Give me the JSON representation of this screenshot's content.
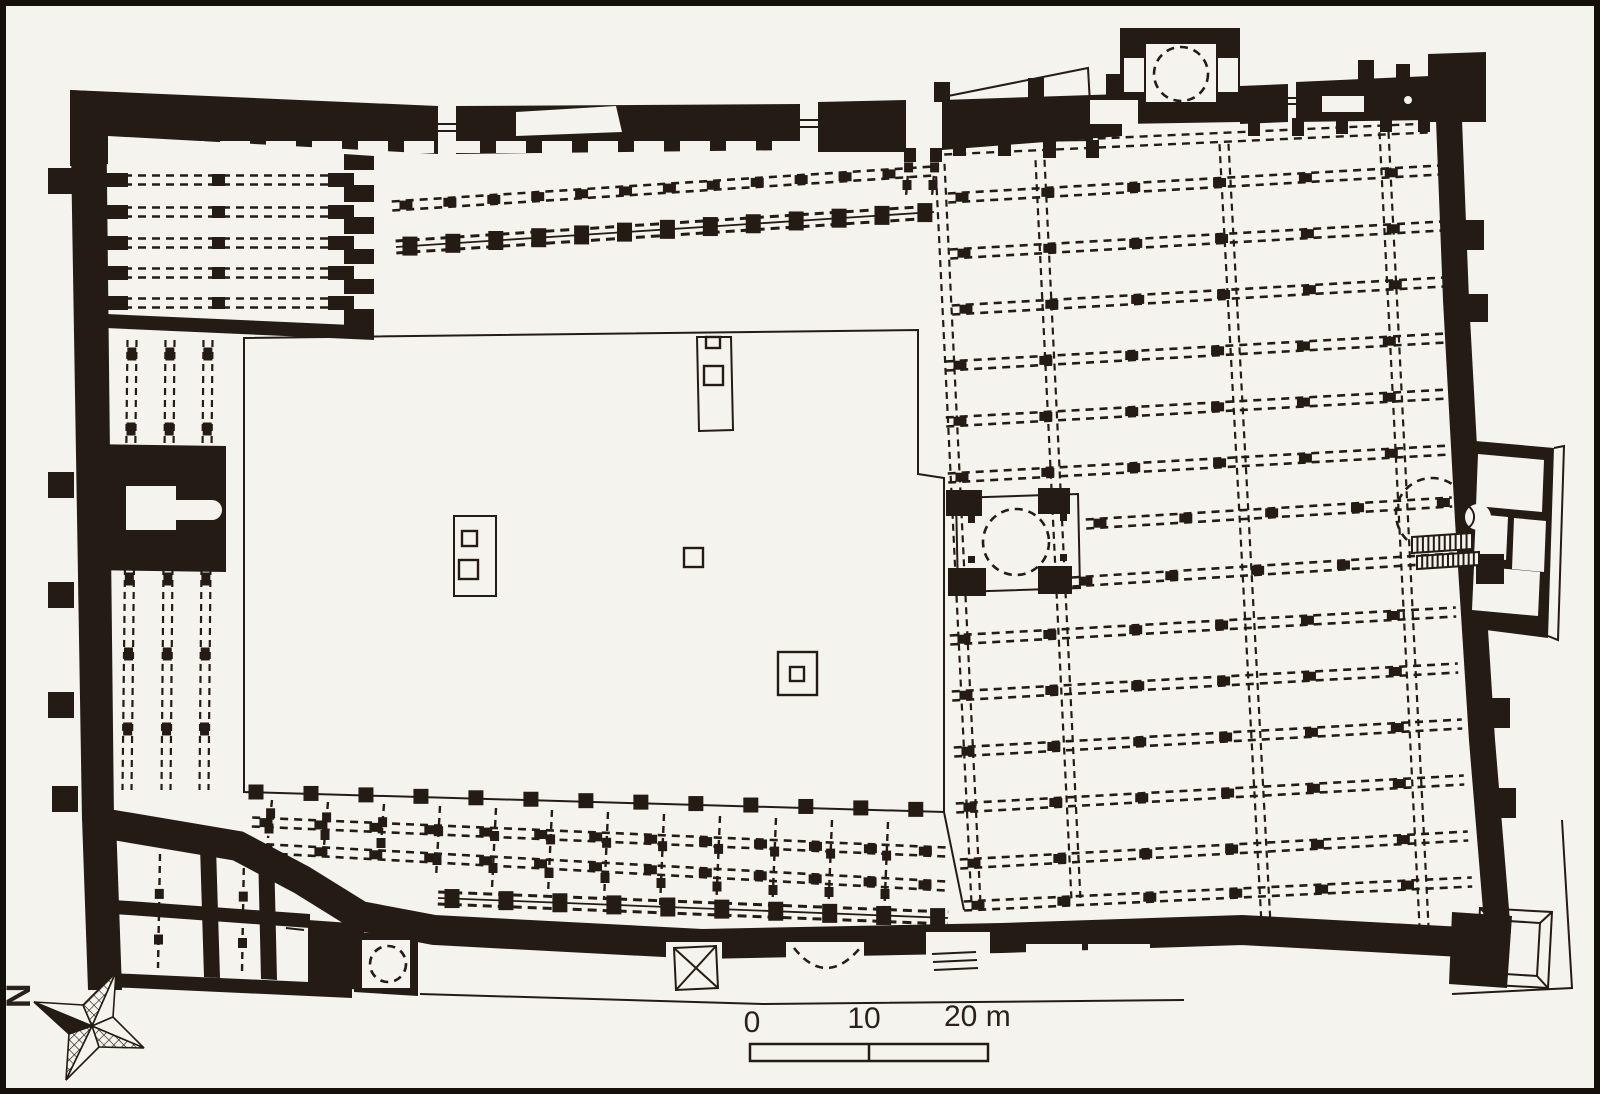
{
  "meta": {
    "kind": "architectural-floor-plan",
    "subject": "hypostyle mosque plan with central courtyard, riwaq arcades, qibla hall, dome bays, mihrab"
  },
  "colors": {
    "ink": "#241b15",
    "paper": "#f5f3ed",
    "frame": "#16100a",
    "text": "#2a211c"
  },
  "compass": {
    "label": "N",
    "polys": [
      {
        "pts": "34,1002 83,1005 92,1026",
        "f": "paper"
      },
      {
        "pts": "34,1002 92,1026 69,1034",
        "f": "ink"
      },
      {
        "pts": "116,972 83,1005 92,1026",
        "f": "hatch"
      },
      {
        "pts": "116,972 92,1026 113,1017",
        "f": "paper"
      },
      {
        "pts": "144,1048 113,1017 92,1026",
        "f": "paper"
      },
      {
        "pts": "144,1048 92,1026 99,1047",
        "f": "hatch"
      },
      {
        "pts": "66,1080 69,1034 92,1026",
        "f": "hatch"
      },
      {
        "pts": "66,1080 92,1026 99,1047",
        "f": "paper"
      }
    ]
  },
  "scalebar": {
    "x": 750,
    "y": 1044,
    "w": 238,
    "h": 17,
    "div": 869,
    "labels": [
      {
        "t": "0",
        "x": 752,
        "y": 1032,
        "a": "middle"
      },
      {
        "t": "10",
        "x": 864,
        "y": 1028,
        "a": "middle"
      },
      {
        "t": "20 m",
        "x": 944,
        "y": 1026,
        "a": "start"
      }
    ]
  },
  "plan": {
    "walls": [
      "M70,90 L438,106 L438,154 L108,136 L108,164 L70,166 Z",
      "M456,106 L800,104 L800,150 L456,154 Z",
      "M818,102 L906,100 L906,152 L818,152 Z",
      "M942,100 L1122,94 L1122,136 L942,150 Z",
      "M1120,28 L1240,28 L1240,122 L1120,124 Z",
      "M1240,86 L1288,84 L1288,122 L1240,124 Z",
      "M1296,82 L1430,76 L1430,120 L1296,122 Z",
      "M1428,54 L1486,52 L1486,122 L1428,122 Z",
      "M70,90 L106,92 L114,820 L82,820 Z",
      "M344,154 L374,156 L374,334 L344,332 Z",
      "M106,314 L374,326 L374,340 L106,328 Z",
      "M84,444 L226,446 L226,572 L84,570 Z",
      "M308,920 L364,924 L364,990 L308,986 Z",
      "M354,932 L418,936 L418,996 L354,992 Z",
      "M82,818 L116,820 L122,990 L88,990 Z",
      "M88,972 L352,984 L352,998 L88,986 Z",
      "M114,900 L310,914 L310,928 L114,914 Z",
      "M200,846 L216,847 L220,978 L204,977 Z",
      "M258,850 L274,851 L277,980 L261,979 Z",
      "M1464,440 L1554,448 L1548,638 L1470,628 Z",
      "M1452,912 L1512,916 L1507,988 L1449,984 Z"
    ],
    "wallStrokes": [
      {
        "d": "M1448,94 L1456,300 L1468,520 L1482,740 L1498,934",
        "w": 26
      },
      {
        "d": "M96,822 L238,846 L302,880 L360,916 L434,930 L702,944 L1002,938 L1242,930 L1462,942",
        "w": 30
      }
    ],
    "blocks": [
      [
        1458,
        220,
        26,
        30
      ],
      [
        1462,
        294,
        26,
        28
      ],
      [
        1476,
        554,
        28,
        30
      ],
      [
        1482,
        698,
        28,
        30
      ],
      [
        1488,
        788,
        28,
        30
      ],
      [
        934,
        82,
        16,
        20
      ],
      [
        1028,
        78,
        16,
        20
      ],
      [
        1106,
        74,
        16,
        22
      ],
      [
        1358,
        60,
        16,
        20
      ],
      [
        1396,
        64,
        14,
        18
      ],
      [
        953,
        138,
        13,
        18
      ],
      [
        998,
        138,
        13,
        18
      ],
      [
        1043,
        140,
        13,
        18
      ],
      [
        1086,
        140,
        13,
        18
      ],
      [
        1248,
        118,
        12,
        18
      ],
      [
        1292,
        118,
        12,
        18
      ],
      [
        1336,
        116,
        12,
        18
      ],
      [
        1380,
        114,
        12,
        18
      ],
      [
        1418,
        114,
        12,
        18
      ],
      [
        48,
        168,
        26,
        26
      ],
      [
        48,
        472,
        26,
        26
      ],
      [
        48,
        582,
        26,
        26
      ],
      [
        48,
        692,
        26,
        26
      ],
      [
        52,
        786,
        26,
        26
      ],
      [
        102,
        173,
        26,
        14
      ],
      [
        328,
        173,
        26,
        14
      ],
      [
        212,
        174,
        13,
        12
      ],
      [
        102,
        205,
        26,
        14
      ],
      [
        328,
        205,
        26,
        14
      ],
      [
        212,
        206,
        13,
        12
      ],
      [
        102,
        236,
        26,
        14
      ],
      [
        328,
        236,
        26,
        14
      ],
      [
        212,
        237,
        13,
        12
      ],
      [
        102,
        266,
        26,
        14
      ],
      [
        328,
        266,
        26,
        14
      ],
      [
        212,
        267,
        13,
        12
      ],
      [
        102,
        296,
        26,
        14
      ],
      [
        328,
        296,
        26,
        14
      ],
      [
        212,
        297,
        13,
        12
      ],
      [
        946,
        490,
        36,
        26
      ],
      [
        1038,
        488,
        32,
        26
      ],
      [
        948,
        568,
        38,
        28
      ],
      [
        1038,
        566,
        34,
        28
      ],
      [
        968,
        516,
        7,
        7
      ],
      [
        1060,
        514,
        7,
        7
      ],
      [
        968,
        556,
        7,
        7
      ],
      [
        1060,
        554,
        7,
        7
      ],
      [
        904,
        148,
        12,
        14
      ],
      [
        930,
        148,
        12,
        14
      ]
    ],
    "whitePaths": [
      "M1146,44 L1216,44 L1216,102 L1146,102 Z",
      "M516,112 L616,106 L622,132 L516,136 Z",
      "M1478,454 L1544,460 L1542,512 L1476,506 Z",
      "M1476,514 L1508,517 L1506,560 L1474,557 Z",
      "M1514,518 L1546,521 L1544,572 L1512,569 Z",
      "M1474,566 L1540,572 L1538,616 L1472,610 Z"
    ],
    "whiteRects": [
      [
        1124,
        58,
        20,
        34
      ],
      [
        1218,
        58,
        20,
        34
      ],
      [
        1090,
        100,
        48,
        24
      ],
      [
        1322,
        96,
        42,
        16
      ],
      [
        344,
        170,
        32,
        15
      ],
      [
        344,
        202,
        32,
        15
      ],
      [
        344,
        234,
        32,
        15
      ],
      [
        344,
        264,
        32,
        15
      ],
      [
        344,
        294,
        32,
        15
      ],
      [
        126,
        486,
        50,
        44
      ],
      [
        666,
        942,
        56,
        52
      ],
      [
        786,
        942,
        78,
        50
      ],
      [
        926,
        932,
        64,
        56
      ],
      [
        1026,
        944,
        56,
        42
      ],
      [
        1088,
        944,
        62,
        42
      ],
      [
        362,
        940,
        48,
        48
      ]
    ],
    "roundRects": [
      {
        "x": 166,
        "y": 500,
        "w": 56,
        "h": 20,
        "rx": 10
      }
    ],
    "notchRow": {
      "x0": 128,
      "step": 46,
      "count": 15,
      "y": 141,
      "w": 30,
      "h": 12
    },
    "rows": [
      {
        "k": "rl",
        "p": [
          392,
          206,
          934,
          171
        ],
        "s": 44
      },
      {
        "k": "rh",
        "p": [
          396,
          247,
          934,
          212
        ],
        "s": 43
      },
      {
        "k": "rp",
        "p": [
          110,
          180,
          342,
          180
        ]
      },
      {
        "k": "rp",
        "p": [
          110,
          212,
          342,
          212
        ]
      },
      {
        "k": "rp",
        "p": [
          110,
          243,
          342,
          243
        ]
      },
      {
        "k": "rp",
        "p": [
          110,
          273,
          342,
          273
        ]
      },
      {
        "k": "rp",
        "p": [
          110,
          303,
          342,
          303
        ]
      },
      {
        "k": "rp",
        "p": [
          944,
          150,
          1428,
          128
        ]
      },
      {
        "k": "ap",
        "p": [
          132,
          340,
          127,
          790
        ],
        "s": 75
      },
      {
        "k": "ap",
        "p": [
          170,
          340,
          166,
          790
        ],
        "s": 75
      },
      {
        "k": "ap",
        "p": [
          208,
          340,
          204,
          790
        ],
        "s": 75
      },
      {
        "k": "rl",
        "p": [
          948,
          198,
          1440,
          170
        ],
        "s": 86
      },
      {
        "k": "rl",
        "p": [
          950,
          254,
          1442,
          226
        ],
        "s": 86
      },
      {
        "k": "rl",
        "p": [
          952,
          310,
          1444,
          282
        ],
        "s": 86
      },
      {
        "k": "rl",
        "p": [
          946,
          366,
          1446,
          338
        ],
        "s": 86
      },
      {
        "k": "rl",
        "p": [
          946,
          422,
          1448,
          394
        ],
        "s": 86
      },
      {
        "k": "rl",
        "p": [
          948,
          478,
          1450,
          450
        ],
        "s": 86
      },
      {
        "k": "rl",
        "p": [
          1086,
          524,
          1452,
          502
        ],
        "s": 86
      },
      {
        "k": "rl",
        "p": [
          1072,
          582,
          1454,
          558
        ],
        "s": 86
      },
      {
        "k": "rl",
        "p": [
          950,
          640,
          1456,
          612
        ],
        "s": 86
      },
      {
        "k": "rl",
        "p": [
          952,
          696,
          1458,
          668
        ],
        "s": 86
      },
      {
        "k": "rl",
        "p": [
          954,
          752,
          1462,
          724
        ],
        "s": 86
      },
      {
        "k": "rl",
        "p": [
          956,
          808,
          1464,
          780
        ],
        "s": 86
      },
      {
        "k": "rl",
        "p": [
          960,
          864,
          1468,
          836
        ],
        "s": 86
      },
      {
        "k": "rl",
        "p": [
          964,
          906,
          1472,
          882
        ],
        "s": 86
      },
      {
        "k": "ai",
        "p": [
          940,
          164,
          976,
          904
        ]
      },
      {
        "k": "ai",
        "p": [
          1040,
          160,
          1076,
          900
        ]
      },
      {
        "k": "ai",
        "p": [
          1224,
          144,
          1266,
          924
        ]
      },
      {
        "k": "ai",
        "p": [
          1384,
          132,
          1424,
          926
        ]
      },
      {
        "k": "cn",
        "p": [
          910,
          152,
          906,
          196
        ]
      },
      {
        "k": "cn",
        "p": [
          936,
          152,
          932,
          196
        ]
      },
      {
        "k": "rl",
        "p": [
          252,
          822,
          946,
          852
        ],
        "s": 55
      },
      {
        "k": "rl",
        "p": [
          252,
          848,
          946,
          886
        ],
        "s": 55
      },
      {
        "k": "rh",
        "p": [
          438,
          898,
          948,
          918
        ],
        "s": 54
      },
      {
        "k": "cn",
        "p": [
          272,
          800,
          268,
          838
        ]
      },
      {
        "k": "cn",
        "p": [
          328,
          802,
          324,
          846
        ]
      },
      {
        "k": "cn",
        "p": [
          384,
          804,
          380,
          856
        ]
      },
      {
        "k": "cn",
        "p": [
          440,
          806,
          436,
          878
        ]
      },
      {
        "k": "cn",
        "p": [
          496,
          808,
          492,
          888
        ]
      },
      {
        "k": "cn",
        "p": [
          552,
          810,
          548,
          894
        ]
      },
      {
        "k": "cn",
        "p": [
          608,
          812,
          604,
          900
        ]
      },
      {
        "k": "cn",
        "p": [
          664,
          814,
          660,
          906
        ]
      },
      {
        "k": "cn",
        "p": [
          720,
          816,
          716,
          910
        ]
      },
      {
        "k": "cn",
        "p": [
          776,
          818,
          772,
          914
        ]
      },
      {
        "k": "cn",
        "p": [
          832,
          820,
          828,
          916
        ]
      },
      {
        "k": "cn",
        "p": [
          888,
          822,
          884,
          918
        ]
      },
      {
        "k": "cn",
        "p": [
          160,
          854,
          158,
          968
        ]
      },
      {
        "k": "cn",
        "p": [
          244,
          856,
          242,
          972
        ]
      }
    ],
    "pierlines": [
      {
        "p": [
          256,
          792,
          940,
          810
        ],
        "s": 55,
        "w": 15,
        "h": 15
      }
    ],
    "underPaths": [
      "M948,96 L1088,68 L1092,140 L950,142 Z"
    ],
    "thinPaths": [
      "M244,338 L918,330 L918,474 L944,478 L944,812 L244,792 Z",
      "M956,498 L1078,494 L1080,588 L958,592 Z",
      "M454,516 L496,516 L496,596 L454,596 Z",
      "M697,337 L731,337 L733,430 L699,431 Z",
      "M674,948 L716,946 L718,988 L676,990 Z",
      "M1480,908 L1552,912 L1548,988 L1476,984 Z",
      "M1492,920 L1540,923 L1537,976 L1489,973 Z",
      "M1554,448 L1564,446 L1558,640 L1548,636",
      "M1452,994 L1572,988 L1562,820",
      "M420,994 L764,1004 L1184,1000"
    ],
    "thinRects": [
      [
        462,
        531,
        15,
        15
      ],
      [
        459,
        560,
        19,
        19
      ],
      [
        706,
        337,
        14,
        11
      ],
      [
        704,
        366,
        19,
        19
      ],
      [
        684,
        548,
        19,
        19
      ],
      [
        778,
        652,
        39,
        43
      ],
      [
        790,
        667,
        14,
        14
      ]
    ],
    "thinLines": [
      [
        433,
        124,
        457,
        124
      ],
      [
        433,
        131,
        457,
        131
      ],
      [
        798,
        120,
        822,
        120
      ],
      [
        798,
        127,
        822,
        127
      ],
      [
        1288,
        98,
        1298,
        98
      ],
      [
        1288,
        104,
        1298,
        104
      ],
      [
        944,
        812,
        964,
        910
      ],
      [
        674,
        948,
        718,
        988
      ],
      [
        716,
        946,
        676,
        990
      ],
      [
        932,
        954,
        976,
        952
      ],
      [
        933,
        962,
        977,
        960
      ],
      [
        934,
        970,
        978,
        968
      ],
      [
        1222,
        928,
        1258,
        926
      ],
      [
        1223,
        936,
        1259,
        934
      ],
      [
        1224,
        944,
        1260,
        942
      ],
      [
        286,
        914,
        304,
        916
      ],
      [
        286,
        921,
        304,
        923
      ],
      [
        286,
        928,
        304,
        930
      ],
      [
        1480,
        908,
        1492,
        920
      ],
      [
        1552,
        912,
        1540,
        923
      ],
      [
        1548,
        988,
        1537,
        976
      ],
      [
        1476,
        984,
        1489,
        973
      ]
    ],
    "dashedCircles": [
      [
        1181,
        74,
        27
      ],
      [
        1016,
        542,
        33
      ],
      [
        1432,
        514,
        36
      ],
      [
        388,
        964,
        18
      ]
    ],
    "dashedPaths": [
      "M794,948 Q826,988 860,948"
    ],
    "ladders": [
      {
        "x": 1412,
        "y": 537,
        "w": 60,
        "h": 16,
        "dy": 4,
        "n": 11
      },
      {
        "x": 1417,
        "y": 556,
        "w": 62,
        "h": 13,
        "dy": 4,
        "n": 12
      }
    ],
    "rings": [
      [
        1408,
        100,
        5
      ]
    ],
    "mihrab": {
      "cx": 1478,
      "cy": 517,
      "r": 13,
      "arc": "M1468,506 A13,13 0 0 1 1468,528"
    }
  }
}
